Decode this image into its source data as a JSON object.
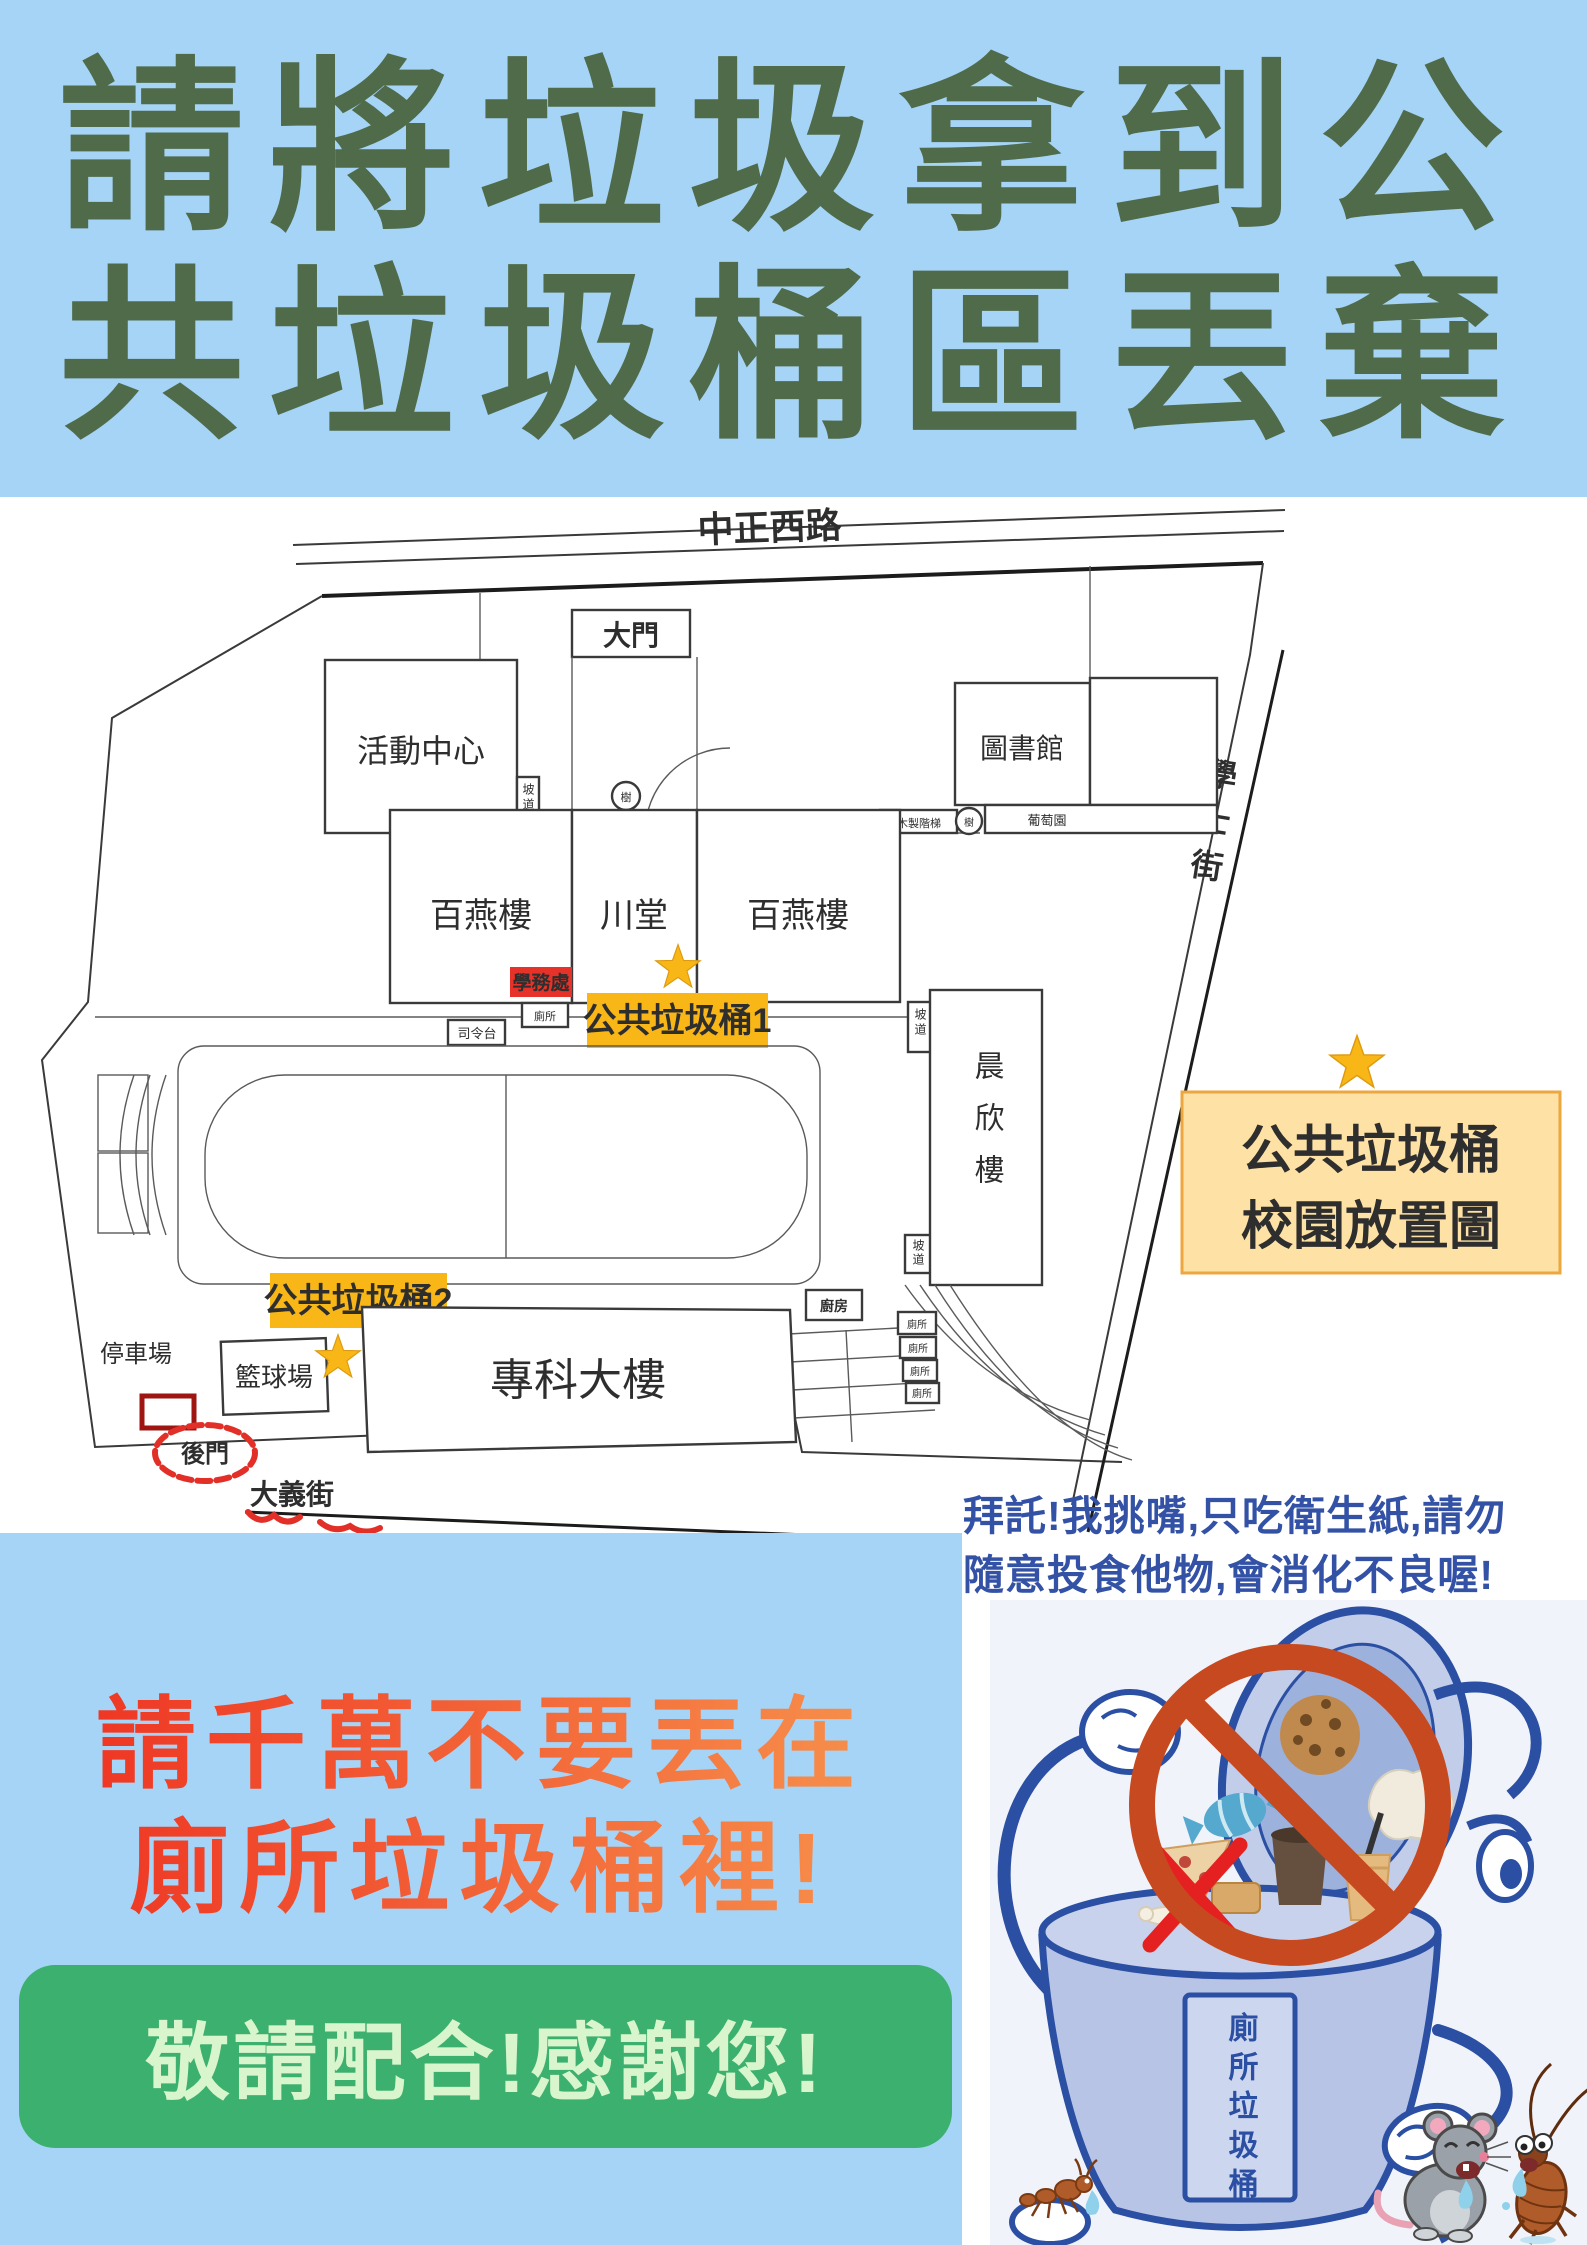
{
  "poster": {
    "title_line1": "請將垃圾拿到公",
    "title_line2": "共垃圾桶區丟棄"
  },
  "map": {
    "street_top": "中正西路",
    "street_right": "學士街",
    "street_bottom": "大義街",
    "gate_main": "大門",
    "gate_back": "後門",
    "activity_center": "活動中心",
    "library": "圖書館",
    "baiyan": "百燕樓",
    "chuantang": "川堂",
    "chenxin": "晨欣樓",
    "zhuanke_building": "專科大樓",
    "basketball_court": "籃球場",
    "parking_lot": "停車場",
    "stage": "司令台",
    "student_affairs": "學務處",
    "wooden_stairs": "木製階梯",
    "grape_garden": "葡萄園",
    "kitchen": "廚房",
    "toilet": "廁所",
    "tree": "樹",
    "ramp": "坡道",
    "public_bin_1": "公共垃圾桶1",
    "public_bin_2": "公共垃圾桶2",
    "legend_line1": "公共垃圾桶",
    "legend_line2": "校園放置圖"
  },
  "bottom_left": {
    "warn_line1": "請千萬不要丟在",
    "warn_line2": "廁所垃圾桶裡!",
    "thanks": "敬請配合!感謝您!"
  },
  "bottom_right": {
    "speech_line1": "拜託!我挑嘴,只吃衛生紙,請勿",
    "speech_line2": "隨意投食他物,會消化不良喔!",
    "bin_label": "廁所垃圾桶"
  },
  "colors": {
    "banner_bg": "#a6d4f6",
    "title_green": "#4f6b49",
    "bin_tag_yellow": "#f9b717",
    "legend_bg": "#fde1a5",
    "legend_border": "#eda73f",
    "alert_red": "#ee3222",
    "alert_orange": "#f7944d",
    "thanks_green": "#3cb06e",
    "thanks_text": "#d9f5ce",
    "speech_blue": "#3352a6",
    "map_street_blue": "#5560c4",
    "gate_orange": "#f0a04a",
    "prohibit_red": "#c7491f",
    "bin_outline_blue": "#2b4fa3"
  }
}
